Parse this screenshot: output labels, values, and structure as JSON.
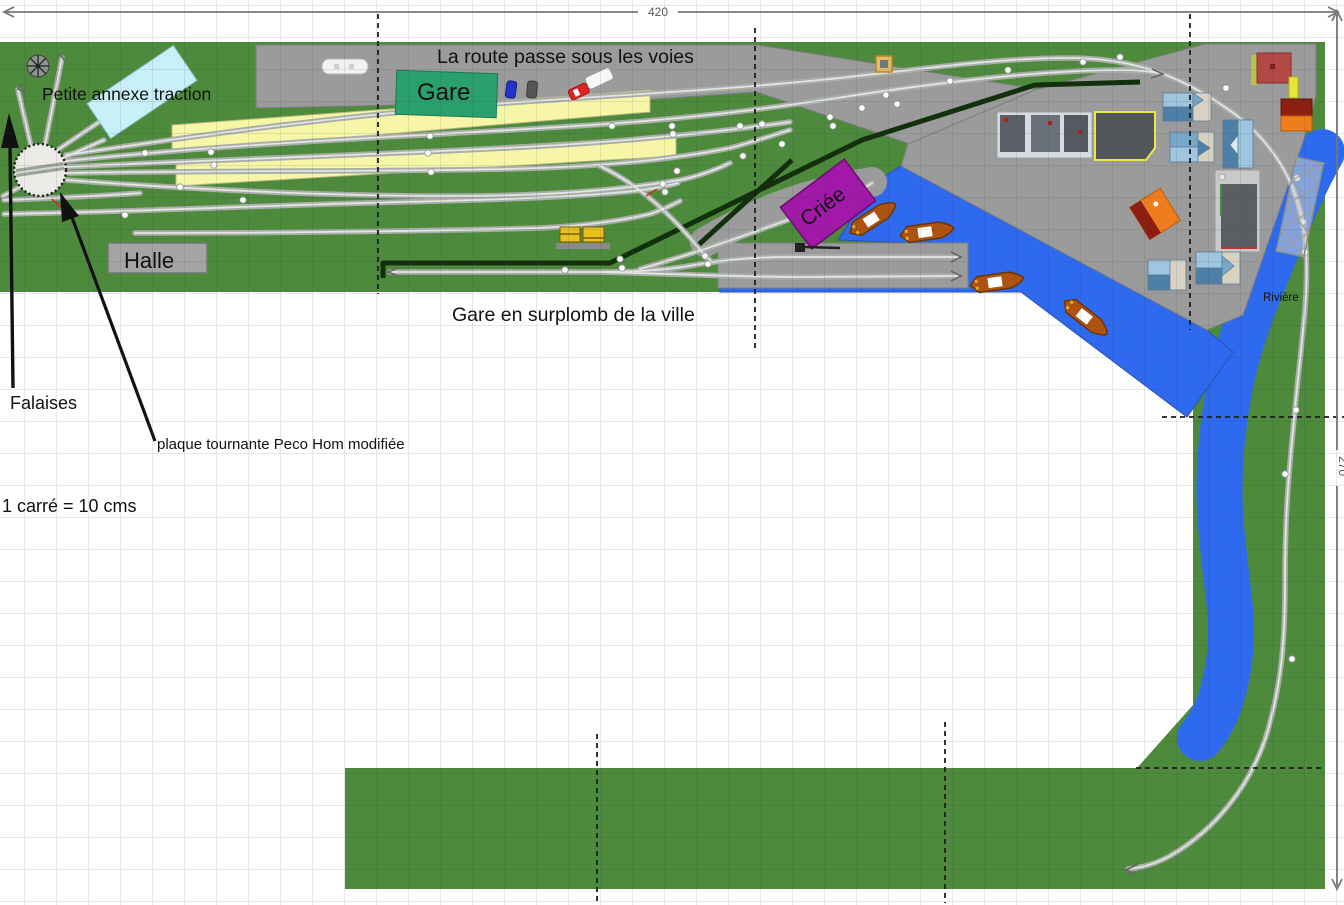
{
  "scale_note": "1 carré = 10 cms",
  "dimension_labels": {
    "horizontal": "420",
    "vertical": "270"
  },
  "annotations": {
    "route": "La route passe sous les voies",
    "gare_overlook": "Gare en surplomb de la ville",
    "falaises": "Falaises",
    "turntable_note": "plaque tournante Peco Hom modifiée",
    "annexe": "Petite annexe traction"
  },
  "buildings": {
    "gare": "Gare",
    "halle": "Halle",
    "criee": "Criée"
  },
  "water": {
    "river_label": "Rivière"
  },
  "colors": {
    "grass": "#4d8a3c",
    "water": "#2e6af0",
    "town_gray": "#9b9b9b",
    "platform_yellow": "#f6f6a6",
    "gare_teal": "#2aa06e",
    "criee_purple": "#a218a8",
    "annexe_cyan": "#c9eff8",
    "halle_gray": "#a4a4a4",
    "track_gray": "#a9aea9",
    "road_dark": "#12300c",
    "boat_hull": "#ad520f",
    "house_roof_blue": "#7fb3d6"
  }
}
